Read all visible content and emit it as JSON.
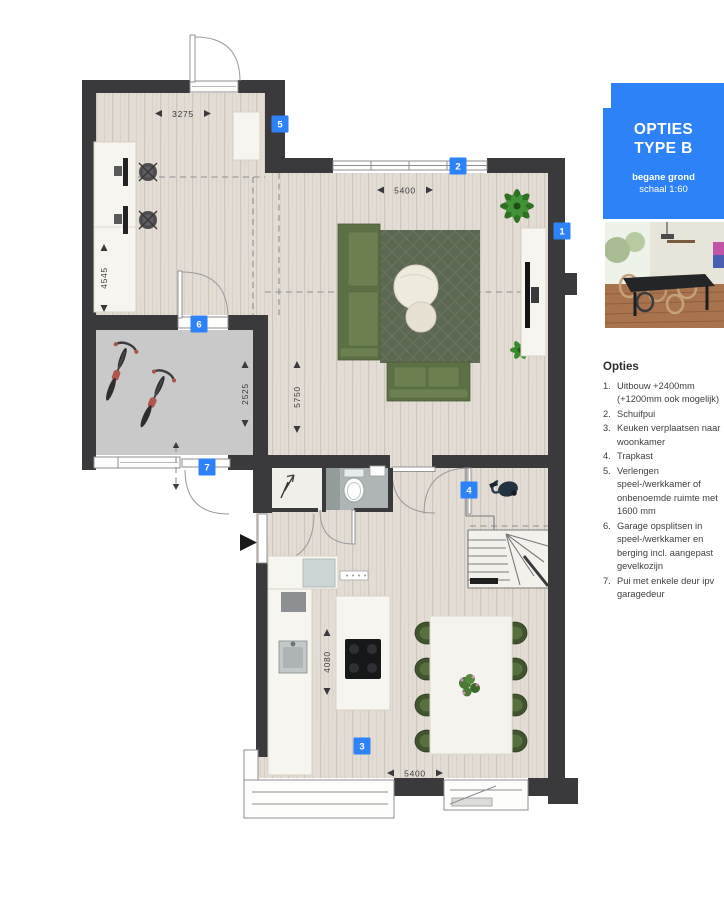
{
  "colors": {
    "accent": "#2e82f7",
    "wall": "#3a3a3c",
    "floor-garage": "#c9c9ca",
    "rug": "#5d6852",
    "sofa": "#5d7045",
    "sofa-cushion": "#6c7f51",
    "dining-chair": "#41532f",
    "text-dark": "#3a3a3c"
  },
  "plan": {
    "badges": [
      "1",
      "2",
      "3",
      "4",
      "5",
      "6",
      "7"
    ],
    "dims": {
      "study_width": "3275",
      "study_depth": "4545",
      "living_width": "5400",
      "living_depth": "5750",
      "garage_depth": "2525",
      "kitchen_depth": "4080",
      "kitchen_width": "5400"
    }
  },
  "sidebar": {
    "title_line1": "OPTIES",
    "title_line2": "TYPE B",
    "subtitle_bold": "begane grond",
    "subtitle": "schaal 1:60",
    "options_heading": "Opties",
    "options": [
      {
        "num": "1.",
        "text": "Uitbouw +2400mm (+1200mm ook mogelijk)"
      },
      {
        "num": "2.",
        "text": "Schuifpui"
      },
      {
        "num": "3.",
        "text": "Keuken verplaatsen naar woonkamer"
      },
      {
        "num": "4.",
        "text": "Trapkast"
      },
      {
        "num": "5.",
        "text": "Verlengen speel-/werkkamer of onbenoemde ruimte met 1600 mm"
      },
      {
        "num": "6.",
        "text": "Garage opsplitsen in speel-/werkkamer en berging incl. aangepast gevelkozijn"
      },
      {
        "num": "7.",
        "text": "Pui met enkele deur ipv garagedeur"
      }
    ]
  }
}
